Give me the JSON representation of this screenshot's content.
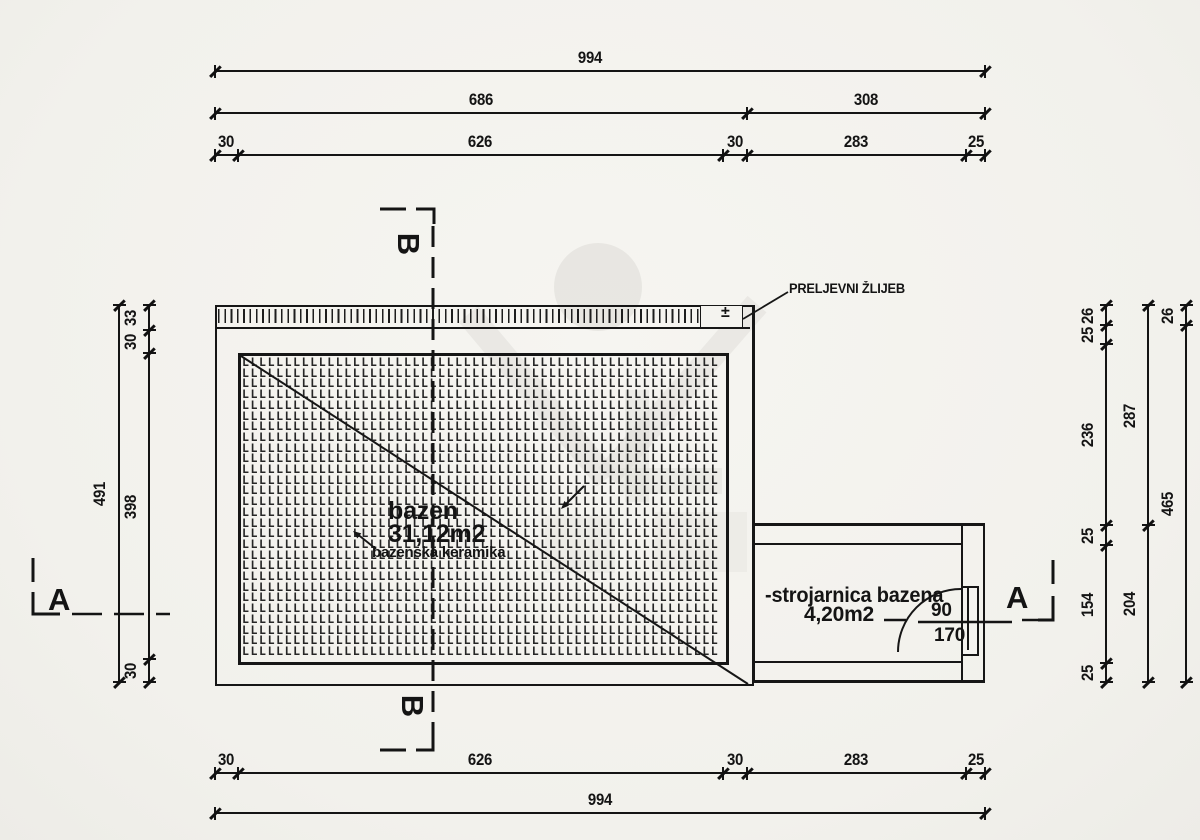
{
  "labels": {
    "overflow_channel": "PRELJEVNI ŽLIJEB",
    "pool_name": "bazen",
    "pool_area": "31,12m2",
    "pool_finish": "bazenska keramika",
    "machine_room_name": "-strojarnica bazena",
    "machine_room_area": "4,20m2",
    "door_width": "90",
    "door_height": "170",
    "plus_minus": "±",
    "section_a": "A",
    "section_b": "B"
  },
  "dimensions": {
    "top": [
      {
        "values": [
          "994"
        ]
      },
      {
        "values": [
          "686",
          "308"
        ]
      },
      {
        "values": [
          "30",
          "626",
          "30",
          "283",
          "25"
        ]
      }
    ],
    "bottom": [
      {
        "values": [
          "30",
          "626",
          "30",
          "283",
          "25"
        ]
      },
      {
        "values": [
          "994"
        ]
      }
    ],
    "left": [
      {
        "values": [
          "491"
        ]
      },
      {
        "values": [
          "33",
          "30",
          "398",
          "30"
        ]
      }
    ],
    "right": [
      {
        "values": [
          "26",
          "25",
          "236",
          "25",
          "154",
          "25"
        ]
      },
      {
        "values": [
          "287",
          "204"
        ]
      },
      {
        "values": [
          "26",
          "465"
        ]
      }
    ]
  }
}
